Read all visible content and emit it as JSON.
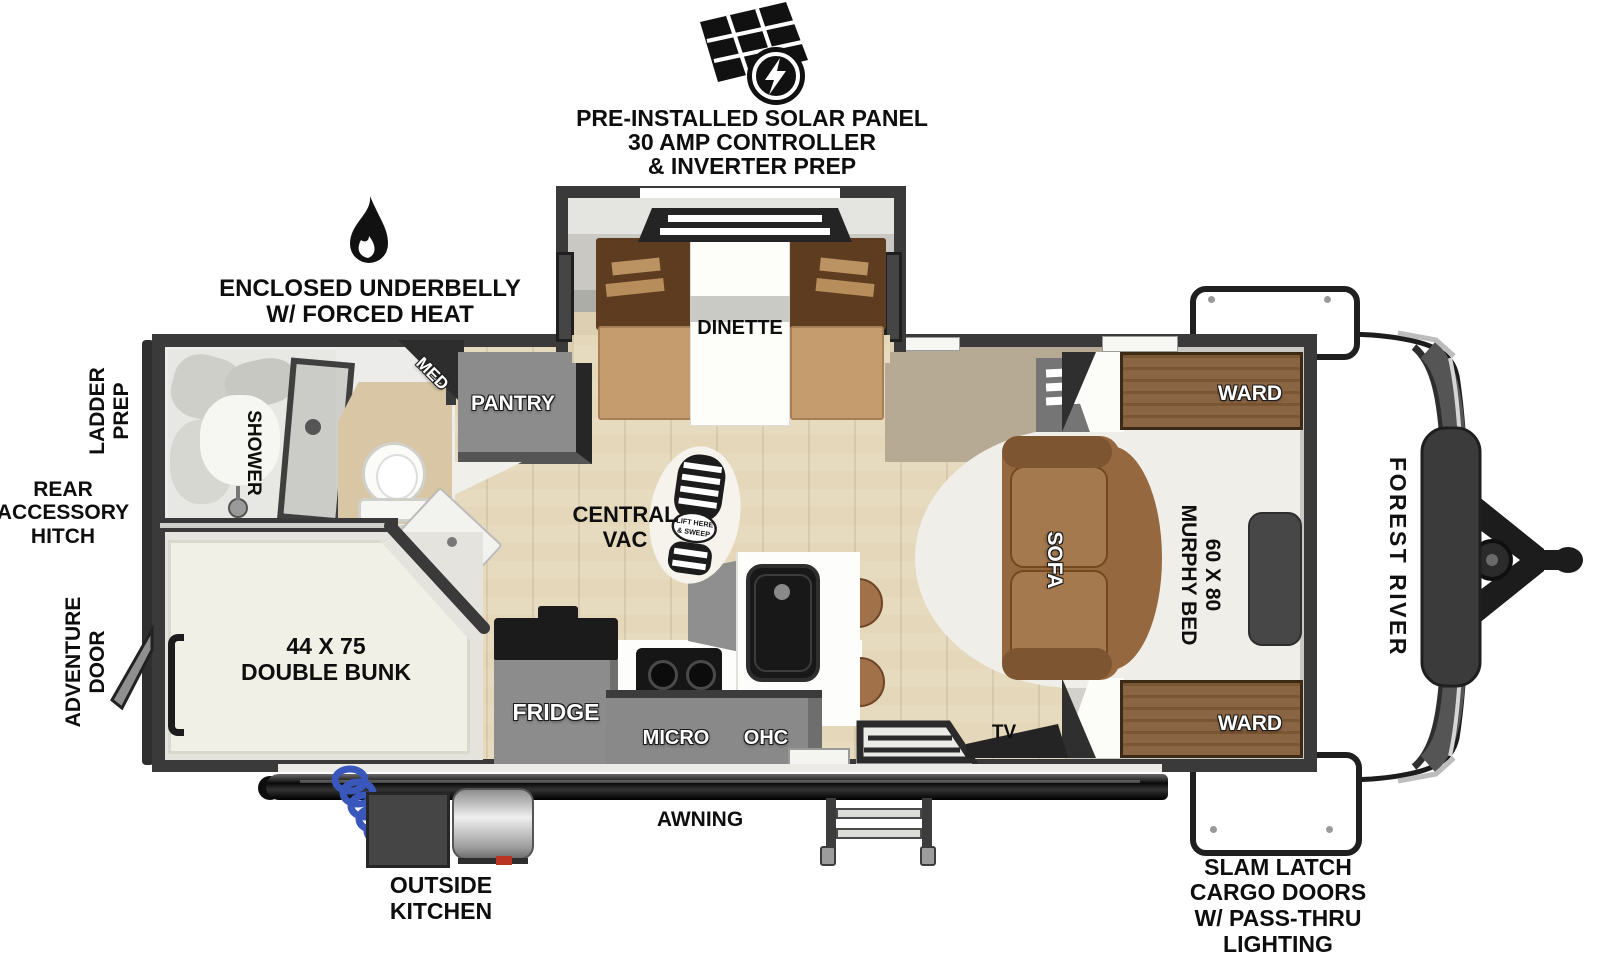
{
  "brand": "FOREST RIVER",
  "exterior": {
    "solar_note": {
      "l1": "PRE-INSTALLED SOLAR PANEL",
      "l2": "30 AMP CONTROLLER",
      "l3": "& INVERTER PREP"
    },
    "underbelly_note": {
      "l1": "ENCLOSED UNDERBELLY",
      "l2": "W/ FORCED HEAT"
    },
    "ladder_prep": {
      "l1": "LADDER",
      "l2": "PREP"
    },
    "rear_hitch": {
      "l1": "REAR",
      "l2": "ACCESSORY",
      "l3": "HITCH"
    },
    "adventure_door": {
      "l1": "ADVENTURE",
      "l2": "DOOR"
    },
    "awning": "AWNING",
    "outside_kitchen": {
      "l1": "OUTSIDE",
      "l2": "KITCHEN"
    },
    "cargo_note": {
      "l1": "SLAM LATCH",
      "l2": "CARGO DOORS",
      "l3": "W/ PASS-THRU",
      "l4": "LIGHTING"
    }
  },
  "interior": {
    "dinette": "DINETTE",
    "pantry": "PANTRY",
    "med": "MED",
    "shower": "SHOWER",
    "bunk": {
      "l1": "44 X 75",
      "l2": "DOUBLE BUNK"
    },
    "central_vac": {
      "l1": "CENTRAL",
      "l2": "VAC"
    },
    "vac_plate": {
      "l1": "LIFT HERE",
      "l2": "& SWEEP"
    },
    "fridge": "FRIDGE",
    "micro": "MICRO",
    "ohc": "OHC",
    "tv": "TV",
    "sofa": "SOFA",
    "murphy": {
      "l1": "60 X 80",
      "l2": "MURPHY BED"
    },
    "ward_top": "WARD",
    "ward_bottom": "WARD"
  },
  "colors": {
    "wall": "#3a3a3a",
    "floor_wood": "#e4d7ba",
    "cabinet_gray": "#898989",
    "wood_ward": "#8a6544",
    "sofa_brown": "#96683f",
    "bench_tan": "#c59c6e",
    "hose_blue": "#3a57bb",
    "bed_white": "#efeee8"
  }
}
